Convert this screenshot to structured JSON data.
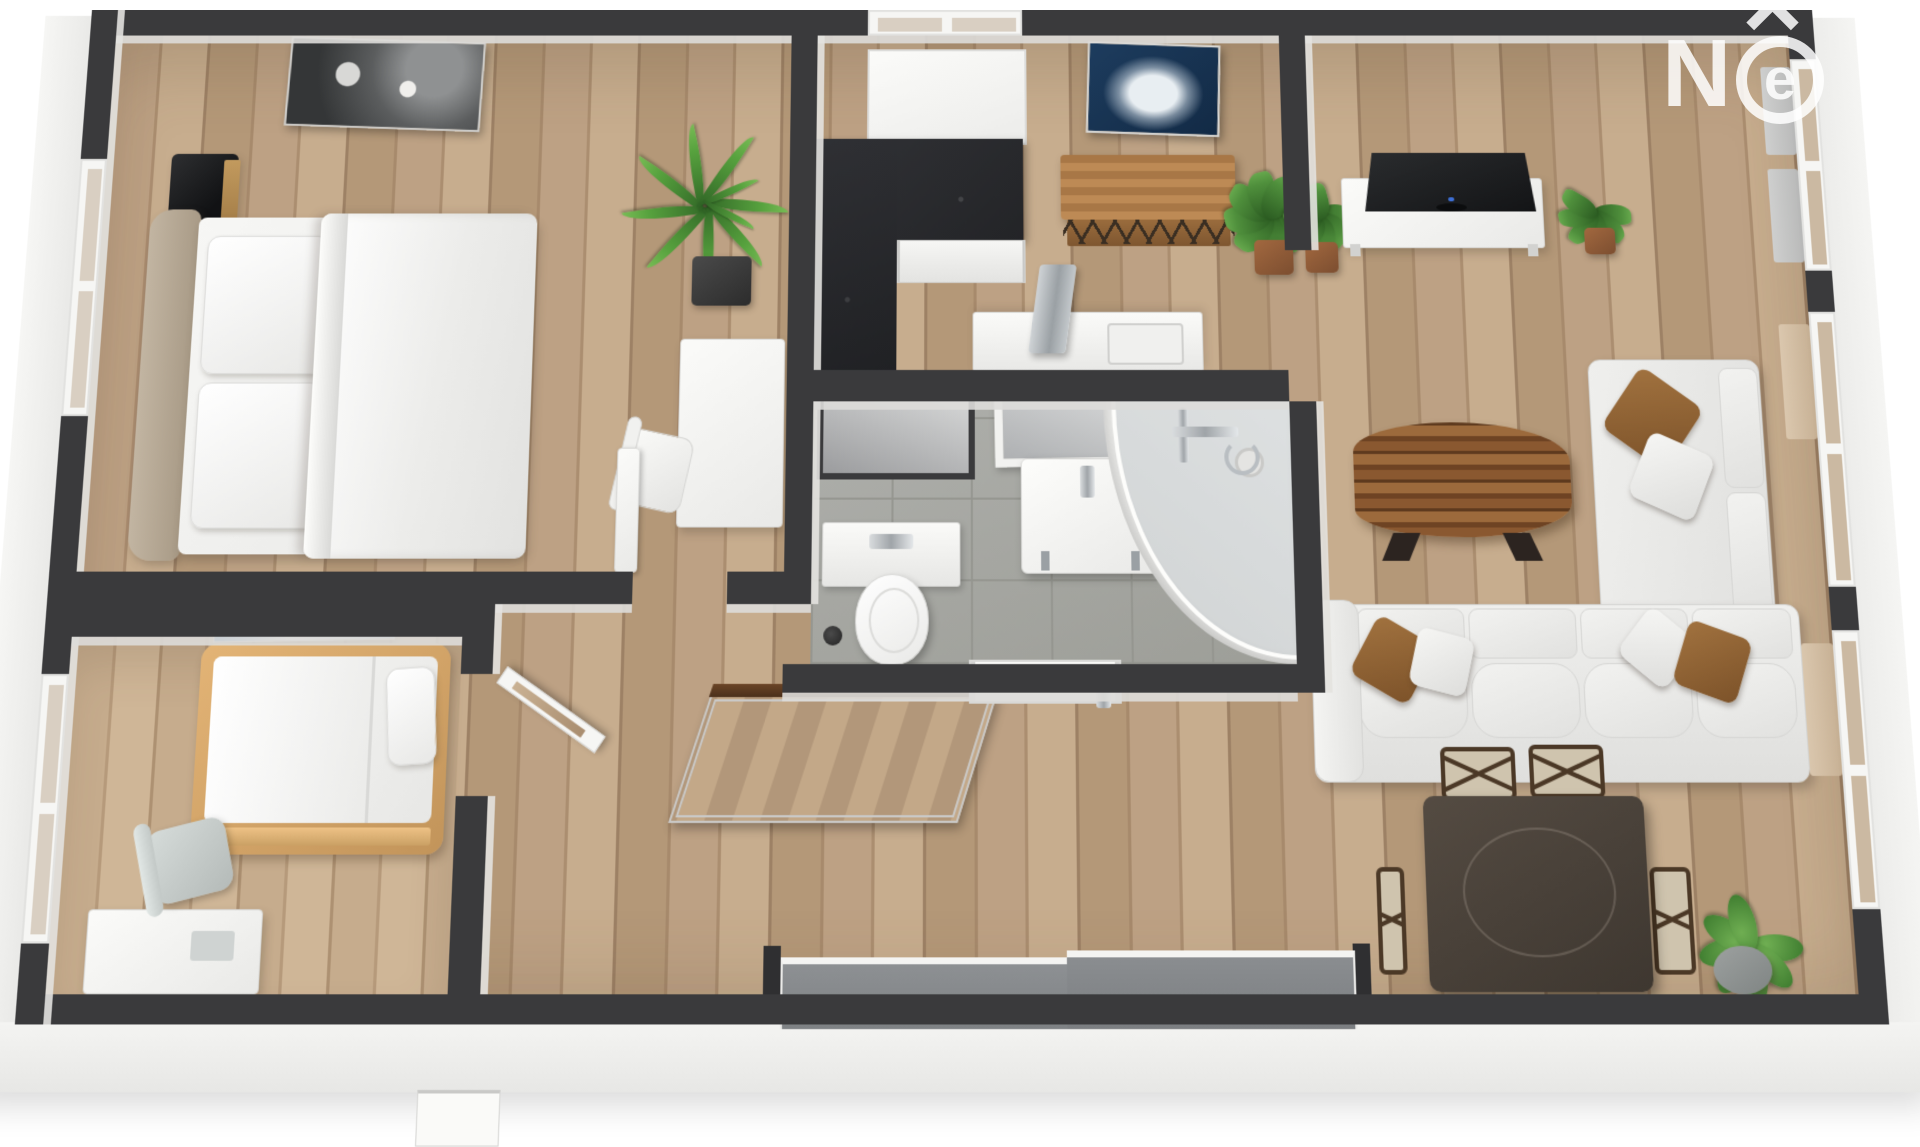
{
  "scene": {
    "type": "3d-floor-plan-render",
    "view": "top-down-perspective",
    "units": "none-shown"
  },
  "watermark": {
    "letter": "N",
    "circled_letter": "e",
    "accent_icon": "caret-up"
  },
  "palette": {
    "wall": "#3a3a3c",
    "wallFace": "#dddcd9",
    "floorA": "#bda184",
    "floorB": "#a98c6e",
    "tile": "#a6a7a3",
    "grout": "#94958f",
    "whiteSurf": "#f4f4f2",
    "counterStone": "#2b2c2e",
    "navyArt": "#17304d",
    "woodConsole": "#b07c4a",
    "woodDark": "#5a3a22",
    "tvDark": "#1d1e20",
    "sofa": "#ebebe9",
    "pillowBrown": "#8e6134",
    "diningTable": "#48413a",
    "chairWood": "#4b3826",
    "seatBeige": "#cfc4ae",
    "leafGreen": "#4f8f3c",
    "leafDark": "#2f6325",
    "potBlack": "#3a3a3a",
    "potClay": "#8d5a3b",
    "potGray": "#8d918f",
    "patioGlass": "#85888b",
    "headboard": "#b2a491",
    "bedFrame": "#d8a869",
    "curtainGray": "#c9cbcc",
    "curtainBeige": "#cbb9a2",
    "skirt": "#f0f0ee"
  },
  "rooms": [
    {
      "id": "bedroom-main",
      "items": [
        "double-bed",
        "upholstered-headboard",
        "two-pillows",
        "white-duvet",
        "marble-nightstand",
        "abstract-wall-art",
        "dracaena-plant",
        "desk",
        "desk-chair",
        "window",
        "door-opening"
      ]
    },
    {
      "id": "bedroom-second",
      "items": [
        "single-bed-wood-frame",
        "pillow",
        "blue-poster",
        "desk",
        "office-chair",
        "window"
      ]
    },
    {
      "id": "kitchen",
      "items": [
        "dark-stone-l-counter",
        "white-cabinet-fronts",
        "window-backsplash",
        "navy-abstract-art",
        "wood-console-table",
        "sink-counter",
        "faucet",
        "monstera-plant"
      ]
    },
    {
      "id": "bathroom",
      "items": [
        "wall-hung-toilet",
        "flush-panel",
        "toilet-brush",
        "vanity-sink",
        "vanity-mirror",
        "corner-shower",
        "shower-fixture",
        "mirror-niche",
        "gray-tile-floor"
      ]
    },
    {
      "id": "hallway",
      "items": [
        "open-interior-door",
        "leaning-floor-mirror",
        "paneled-closet-door",
        "sliding-patio-door"
      ]
    },
    {
      "id": "living-dining",
      "items": [
        "flat-screen-tv",
        "tv-console",
        "monstera-plants",
        "live-edge-coffee-table",
        "l-shaped-sofa",
        "throw-pillows",
        "dark-dining-table",
        "cross-back-chairs",
        "fiddle-leaf-plant",
        "windows-with-curtains"
      ]
    }
  ]
}
